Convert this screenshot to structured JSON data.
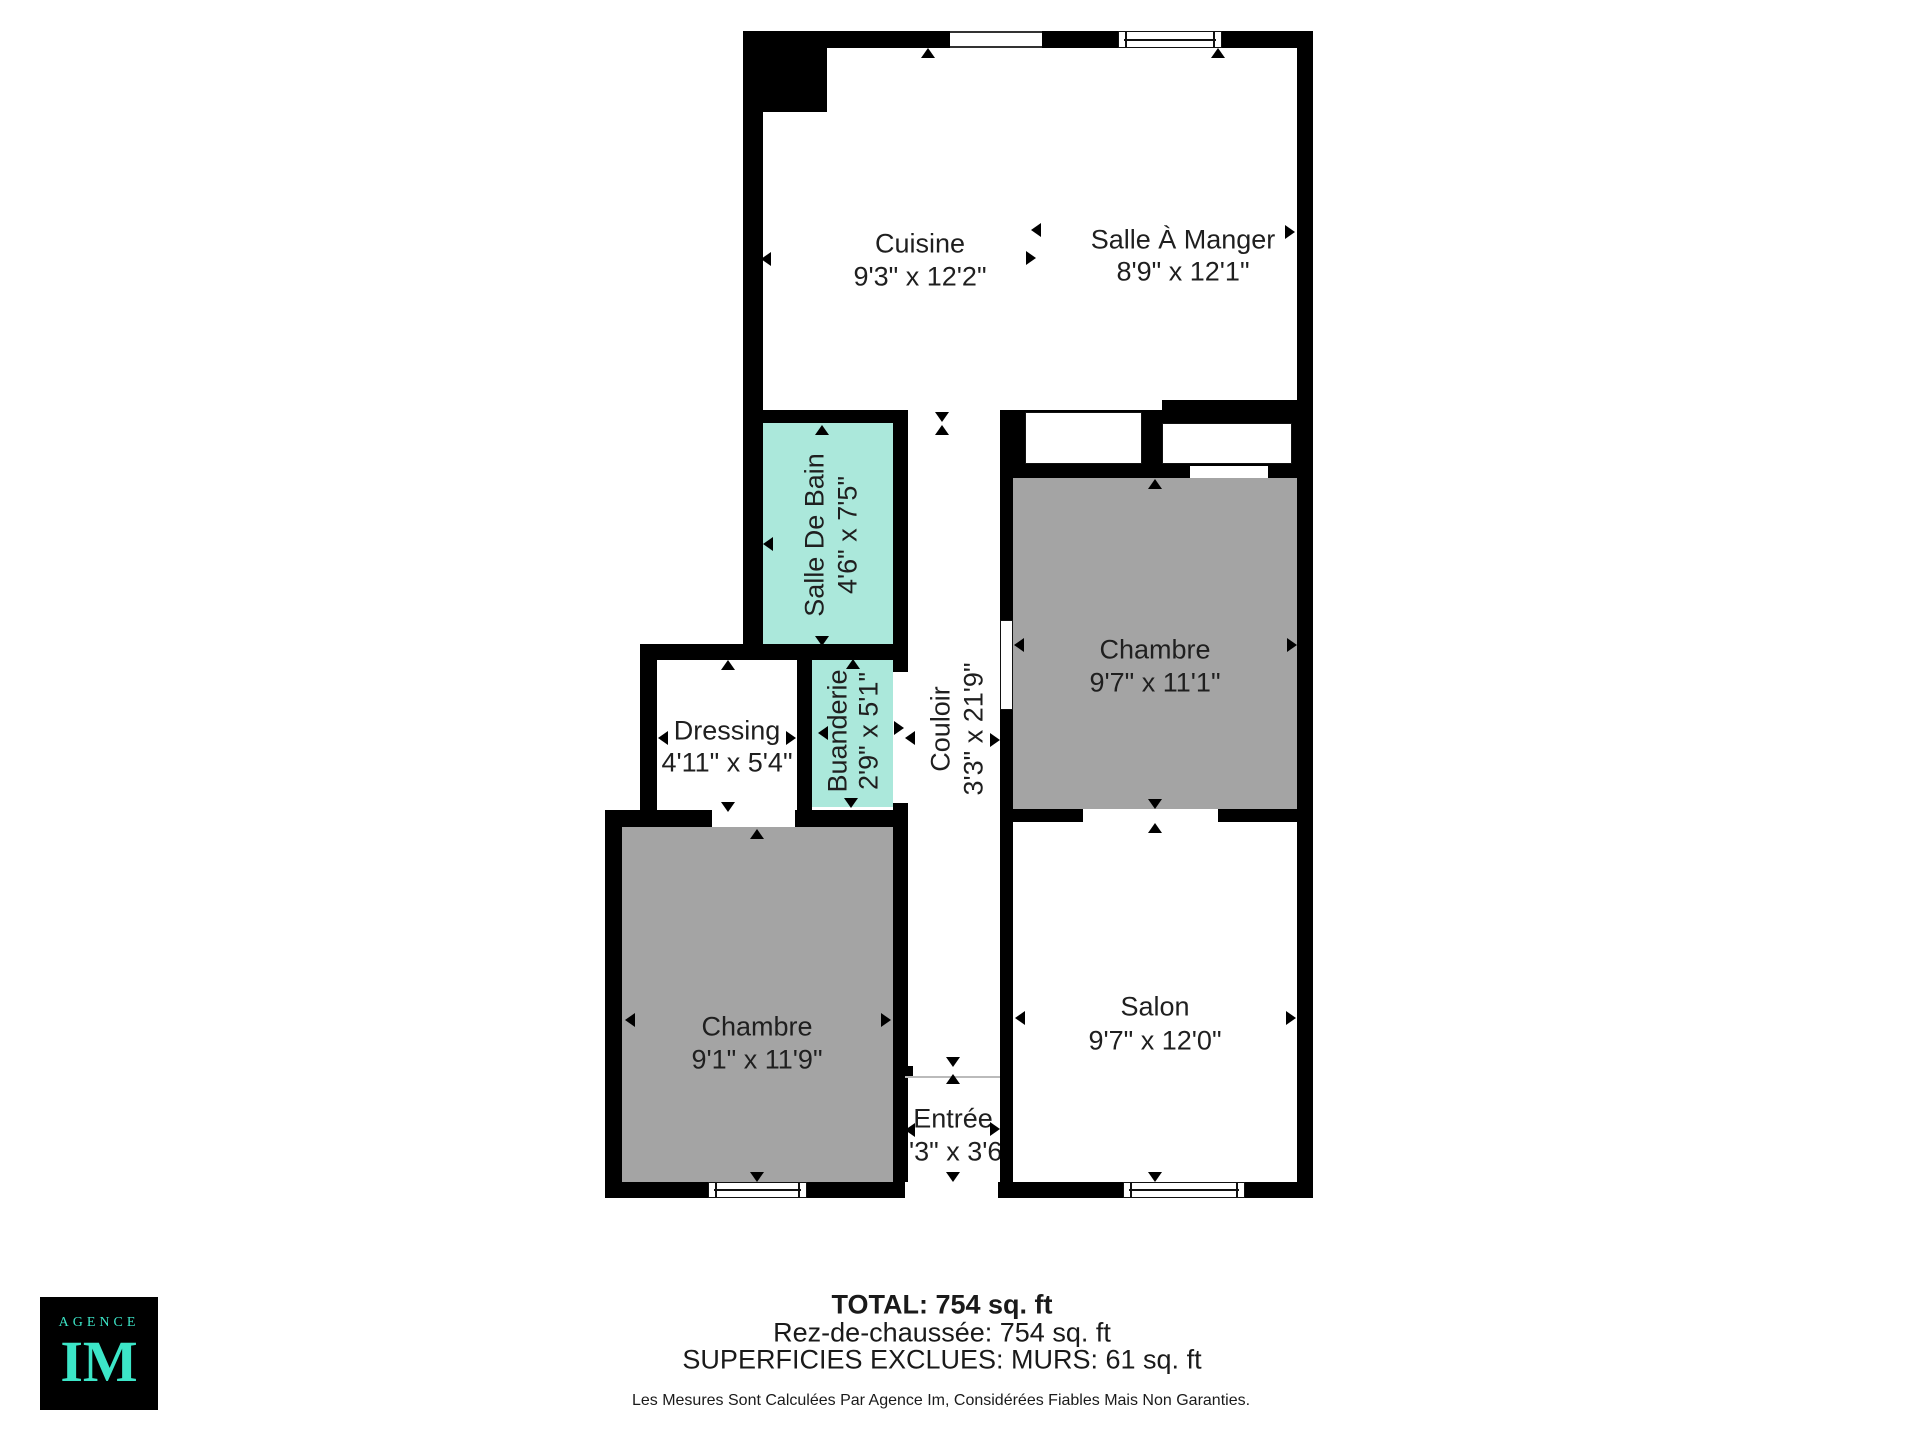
{
  "colors": {
    "wall": "#000000",
    "teal_room": "#abe8db",
    "gray_room": "#a4a4a4",
    "logo_teal": "#3ce6c8",
    "text": "#1f1f1f"
  },
  "floorplan": {
    "rooms": [
      {
        "name": "Cuisine",
        "dims": "9'3\" x 12'2\""
      },
      {
        "name": "Salle À Manger",
        "dims": "8'9\" x 12'1\""
      },
      {
        "name": "Salle De Bain",
        "dims": "4'6\" x 7'5\""
      },
      {
        "name": "Buanderie",
        "dims": "2'9\" x 5'1\""
      },
      {
        "name": "Couloir",
        "dims": "3'3\" x 21'9\""
      },
      {
        "name": "Chambre",
        "dims": "9'7\" x 11'1\""
      },
      {
        "name": "Dressing",
        "dims": "4'11\" x 5'4\""
      },
      {
        "name": "Chambre",
        "dims": "9'1\" x 11'9\""
      },
      {
        "name": "Salon",
        "dims": "9'7\" x 12'0\""
      },
      {
        "name": "Entrée",
        "dims": "3'3\" x 3'6\""
      }
    ]
  },
  "footer": {
    "total": "TOTAL: 754 sq. ft",
    "ground_floor": "Rez-de-chaussée: 754 sq. ft",
    "excluded": "SUPERFICIES EXCLUES: MURS: 61 sq. ft",
    "disclaimer": "Les Mesures Sont Calculées Par Agence Im, Considérées Fiables Mais Non Garanties."
  },
  "logo": {
    "agency": "AGENCE",
    "initials": "IM"
  }
}
